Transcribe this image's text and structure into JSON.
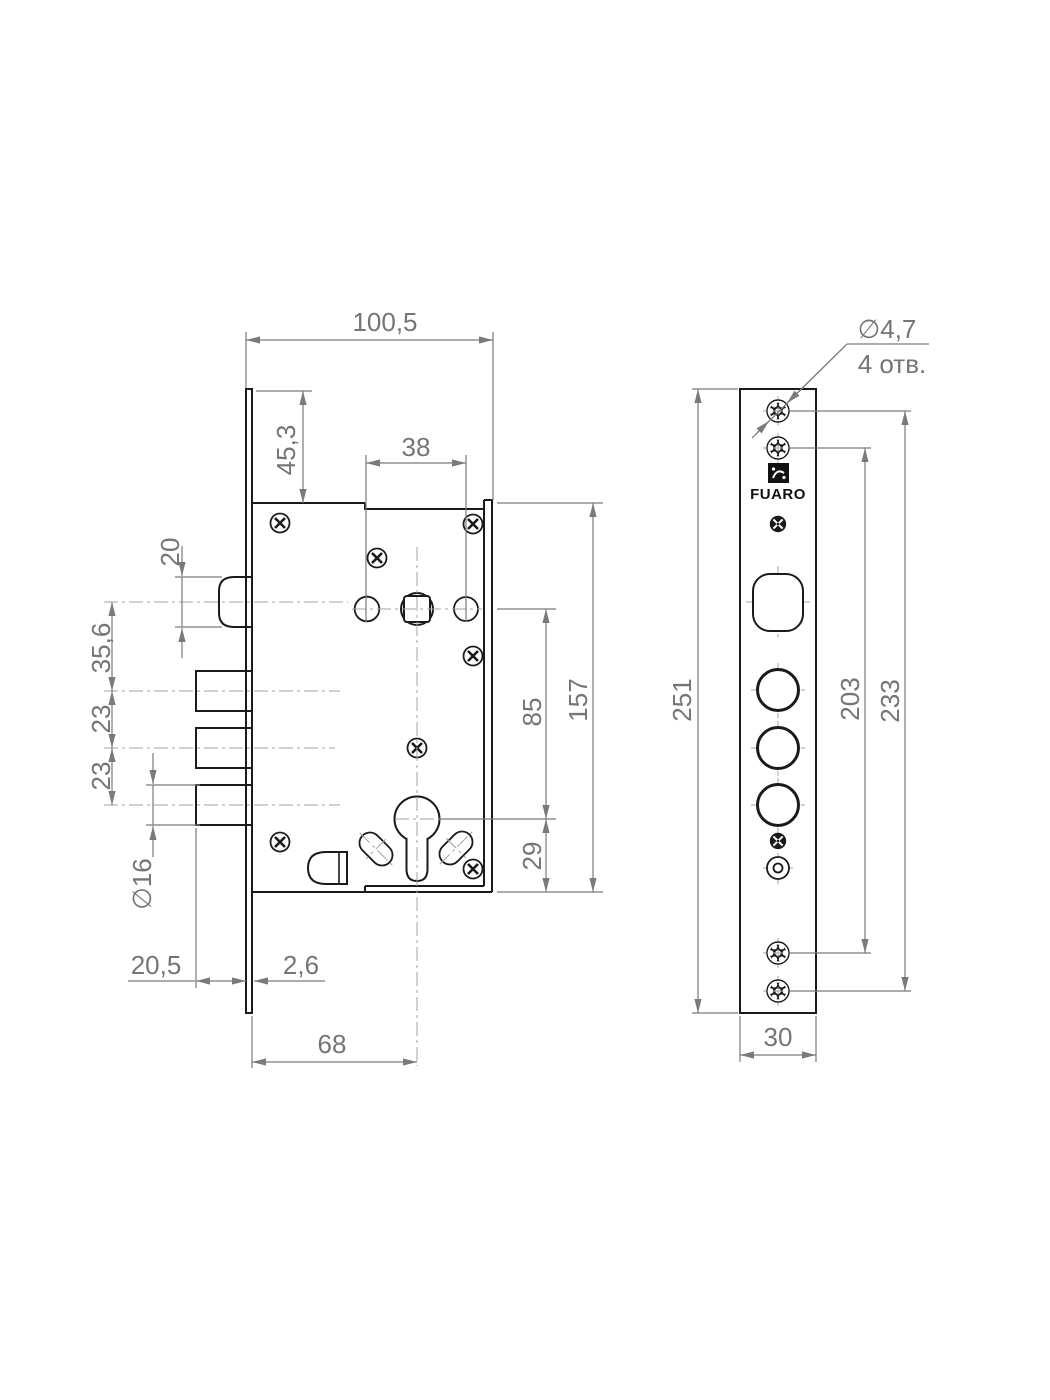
{
  "brand": {
    "name": "FUARO"
  },
  "colors": {
    "object_line": "#1a1a1a",
    "dimension_line": "#7a7a7a",
    "centerline": "#a3a3a3",
    "background": "#ffffff"
  },
  "views": {
    "side_view": "lock body side view",
    "front_view": "faceplate front view"
  },
  "dims": {
    "d100_5": "100,5",
    "d45_3": "45,3",
    "d38": "38",
    "d20": "20",
    "d35_6": "35,6",
    "d23a": "23",
    "d23b": "23",
    "d16": "∅16",
    "d20_5": "20,5",
    "d2_6": "2,6",
    "d68": "68",
    "d85": "85",
    "d157": "157",
    "d29": "29",
    "d251": "251",
    "d203": "203",
    "d233": "233",
    "d30": "30",
    "d4_7": "∅4,7",
    "d4otv": "4 отв."
  }
}
